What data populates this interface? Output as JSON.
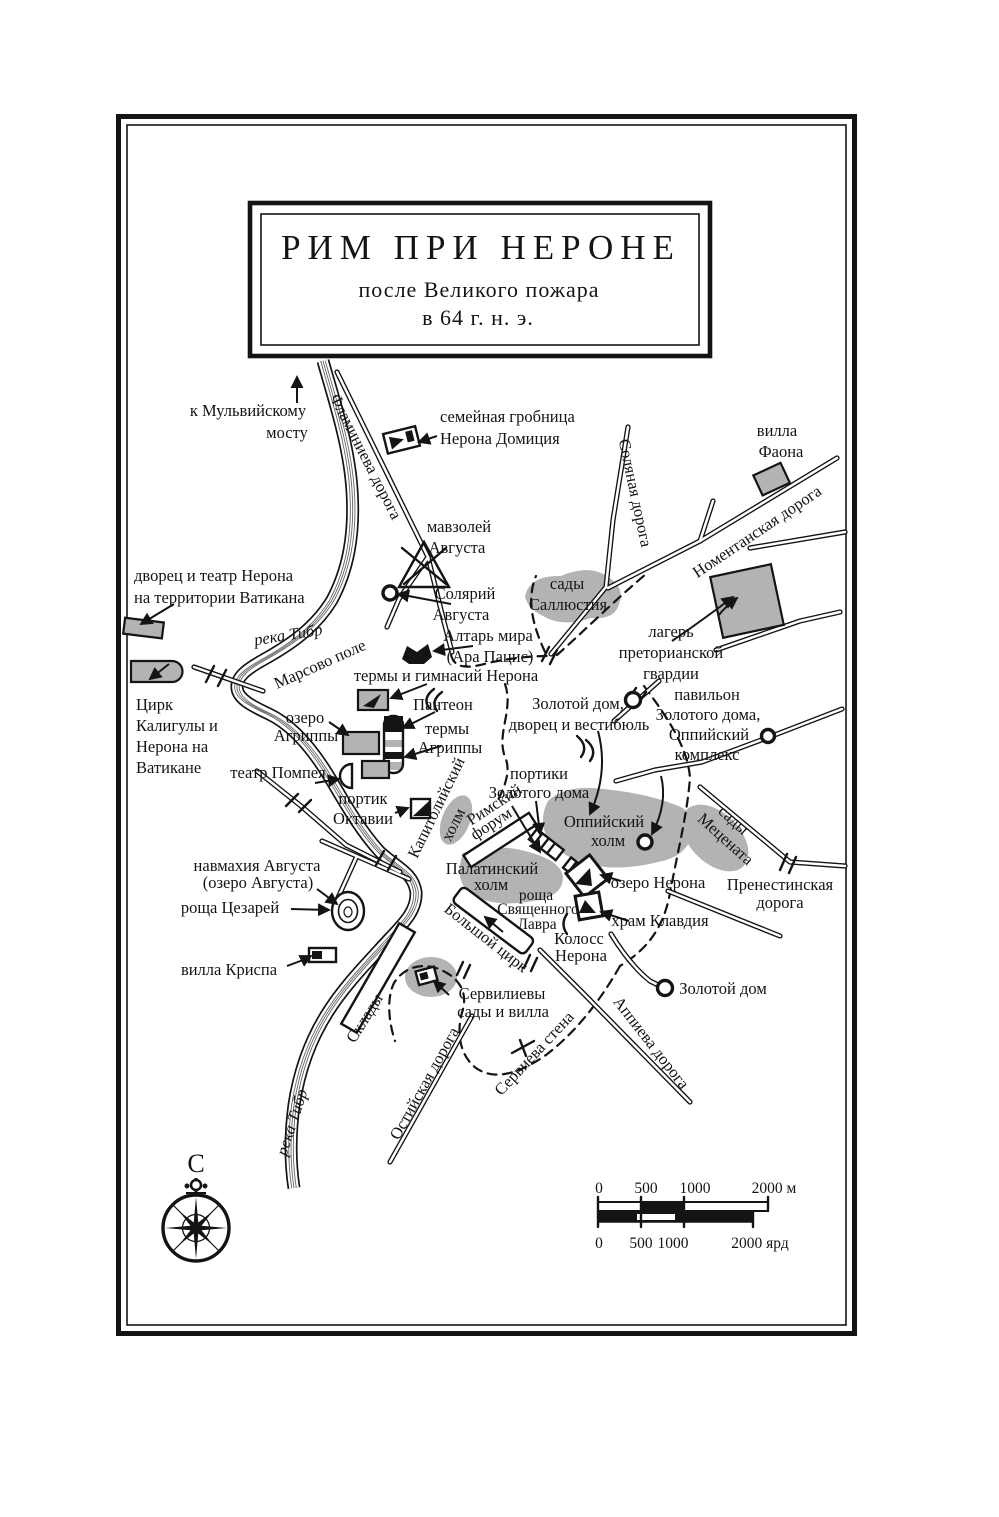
{
  "title": {
    "line1": "РИМ ПРИ НЕРОНЕ",
    "line2": "после Великого пожара",
    "line3": "в 64 г. н. э."
  },
  "labels": {
    "mulvian_bridge": {
      "l1": "к Мульвийскому",
      "l2": "мосту"
    },
    "flaminia_road": {
      "text": "Фламиниева дорога"
    },
    "family_tomb": {
      "l1": "семейная гробница",
      "l2": "Нерона Домиция"
    },
    "villa_phaon": {
      "l1": "вилла",
      "l2": "Фаона"
    },
    "salaria_road": {
      "text": "Соляная дорога"
    },
    "nomentana_road": {
      "text": "Номентанская дорога"
    },
    "mausoleum_augustus": {
      "l1": "мавзолей",
      "l2": "Августа"
    },
    "nero_palace_vatican": {
      "l1": "дворец и театр Нерона",
      "l2": "на территории Ватикана"
    },
    "sallust_gardens": {
      "l1": "сады",
      "l2": "Саллюстия"
    },
    "praetorian_camp": {
      "l1": "лагерь",
      "l2": "преторианской",
      "l3": "гвардии"
    },
    "solarium_augustus": {
      "l1": "Солярий",
      "l2": "Августа"
    },
    "ara_pacis": {
      "l1": "Алтарь мира",
      "l2": "(Ара Пацис)"
    },
    "tiber_river_top": {
      "text": "река Тибр"
    },
    "campus_martius": {
      "text": "Марсово поле"
    },
    "nero_baths": {
      "text": "термы и гимнасий Нерона"
    },
    "circus_caligula": {
      "l1": "Цирк",
      "l2": "Калигулы и",
      "l3": "Нерона на",
      "l4": "Ватикане"
    },
    "agrippa_lake": {
      "l1": "озеро",
      "l2": "Агриппы"
    },
    "pantheon": {
      "text": "Пантеон"
    },
    "agrippa_baths": {
      "l1": "термы",
      "l2": "Агриппы"
    },
    "pompey_theater": {
      "text": "театр Помпея"
    },
    "octavia_portico": {
      "l1": "портик",
      "l2": "Октавии"
    },
    "golden_house_vestibule": {
      "l1": "Золотой дом,",
      "l2": "дворец и вестибюль"
    },
    "golden_house_pavilion": {
      "l1": "павильон",
      "l2": "Золотого дома,",
      "l3": "Оппийский",
      "l4": "комплекс"
    },
    "golden_house_porticoes": {
      "l1": "портики",
      "l2": "Золотого дома"
    },
    "capitoline_hill": {
      "l1": "Капитолийский",
      "l2": "холм"
    },
    "roman_forum": {
      "l1": "Римский",
      "l2": "форум"
    },
    "oppian_hill": {
      "l1": "Оппийский",
      "l2": "холм"
    },
    "maecenas_gardens": {
      "l1": "сады",
      "l2": "Мецената"
    },
    "nero_lake": {
      "text": "озеро Нерона"
    },
    "praenestina_road": {
      "l1": "Пренестинская",
      "l2": "дорога"
    },
    "palatine_hill": {
      "l1": "Палатинский",
      "l2": "холм"
    },
    "sacred_laurel_grove": {
      "l1": "роща",
      "l2": "Священного",
      "l3": "Лавра"
    },
    "claudius_temple": {
      "text": "храм Клавдия"
    },
    "colossus_nero": {
      "l1": "Колосс",
      "l2": "Нерона"
    },
    "naumachia_augustus": {
      "l1": "навмахия Августа",
      "l2": "(озеро Августа)"
    },
    "caesars_grove": {
      "text": "роща Цезарей"
    },
    "villa_crispa": {
      "text": "вилла Криспа"
    },
    "warehouses": {
      "text": "Склады"
    },
    "servilian_gardens": {
      "l1": "Сервилиевы",
      "l2": "сады и вилла"
    },
    "ostia_road": {
      "text": "Остийская дорога"
    },
    "servian_wall": {
      "text": "Сервиева стена"
    },
    "appia_road": {
      "text": "Аппиева дорога"
    },
    "golden_house": {
      "text": "Золотой дом"
    },
    "tiber_river_bottom": {
      "text": "река Тибр"
    },
    "circus_maximus": {
      "text": "Большой цирк"
    }
  },
  "compass": {
    "north": "С"
  },
  "scale": {
    "m": {
      "t0": "0",
      "t1": "500",
      "t2": "1000",
      "t3": "2000 м"
    },
    "yd": {
      "t0": "0",
      "t1": "500",
      "t2": "1000",
      "t3": "2000 ярд"
    }
  },
  "colors": {
    "ink": "#141414",
    "hill_gray": "#b3b3b3",
    "paper": "#ffffff"
  }
}
